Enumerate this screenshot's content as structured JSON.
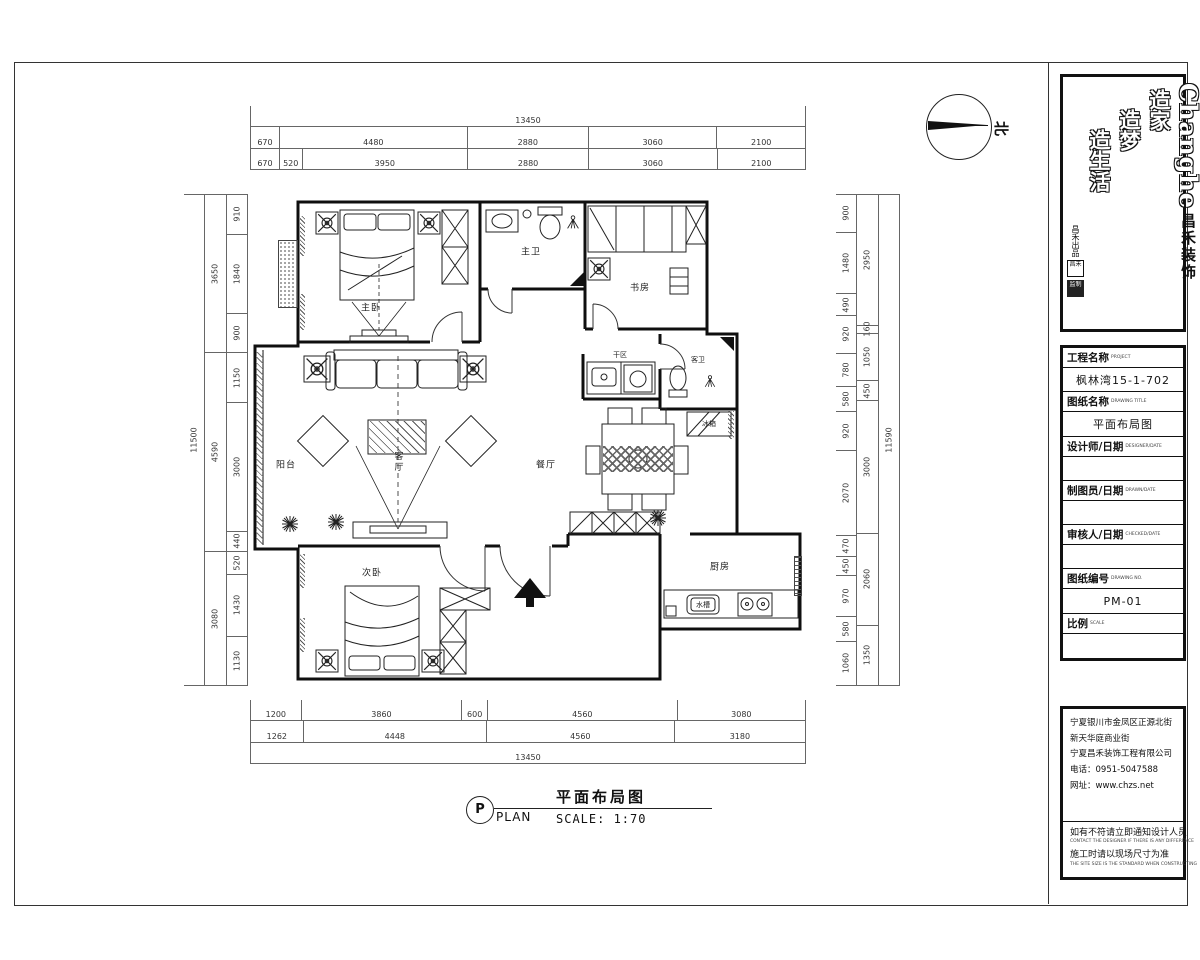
{
  "north": {
    "label": "北"
  },
  "caption": {
    "cn": "平面布局图",
    "tag": "P",
    "en": "PLAN",
    "scale": "SCALE: 1:70"
  },
  "rooms": {
    "master_bedroom": "主卧",
    "master_bath": "主卫",
    "study": "书房",
    "balcony": "阳台",
    "living": "客厅",
    "dining": "餐厅",
    "dry_area": "干区",
    "guest_bath": "客卫",
    "kitchen": "厨房",
    "second_bedroom": "次卧"
  },
  "fixtures": {
    "fridge": "冰箱",
    "sink": "水槽"
  },
  "dims": {
    "top": [
      [
        "13450"
      ],
      [
        "670",
        "4480",
        "2880",
        "3060",
        "2100"
      ],
      [
        "670",
        "520",
        "3950",
        "2880",
        "3060",
        "2100"
      ]
    ],
    "bottom": [
      [
        "1200",
        "3860",
        "600",
        "4560",
        "3080"
      ],
      [
        "1262",
        "4448",
        "4560",
        "3180"
      ],
      [
        "13450"
      ]
    ],
    "left": [
      [
        "11500"
      ],
      [
        "3650",
        "4590",
        "3080"
      ],
      [
        "910",
        "1840",
        "900",
        "1150",
        "3000",
        "440",
        "520",
        "1430",
        "1130"
      ]
    ],
    "right": [
      [
        "900",
        "1480",
        "490",
        "920",
        "780",
        "580",
        "920",
        "2070",
        "470",
        "450",
        "970",
        "580",
        "1060"
      ],
      [
        "2950",
        "160",
        "1050",
        "450",
        "3000",
        "2060",
        "1350"
      ],
      [
        "11590"
      ]
    ]
  },
  "titleblock": {
    "brand_en": "Changhe",
    "brand_cn": "昌禾装饰",
    "slogans": [
      "造家",
      "造梦",
      "造生活"
    ],
    "slogan_small": "昌禾出品",
    "seal1": "昌禾",
    "seal2": "监制",
    "fields": [
      {
        "label": "工程名称",
        "en": "PROJECT",
        "value": "枫林湾15-1-702"
      },
      {
        "label": "图纸名称",
        "en": "DRAWING TITLE",
        "value": "平面布局图"
      },
      {
        "label": "设计师/日期",
        "en": "DESIGNER/DATE",
        "value": ""
      },
      {
        "label": "制图员/日期",
        "en": "DRAWN/DATE",
        "value": ""
      },
      {
        "label": "审核人/日期",
        "en": "CHECKED/DATE",
        "value": ""
      },
      {
        "label": "图纸编号",
        "en": "DRAWING NO.",
        "value": "PM-01"
      },
      {
        "label": "比例",
        "en": "SCALE",
        "value": ""
      }
    ],
    "address": [
      "宁夏银川市金凤区正源北街",
      "新天华庭商业街",
      "宁夏昌禾装饰工程有限公司",
      "电话：0951-5047588",
      "网址：www.chzs.net"
    ],
    "notes": [
      {
        "cn": "如有不符请立即通知设计人员",
        "en": "CONTACT THE DESIGNER IF THERE IS ANY DIFFERENCE"
      },
      {
        "cn": "施工时请以现场尺寸为准",
        "en": "THE SITE SIZE IS THE STANDARD WHEN CONSTRUCTING"
      }
    ]
  }
}
